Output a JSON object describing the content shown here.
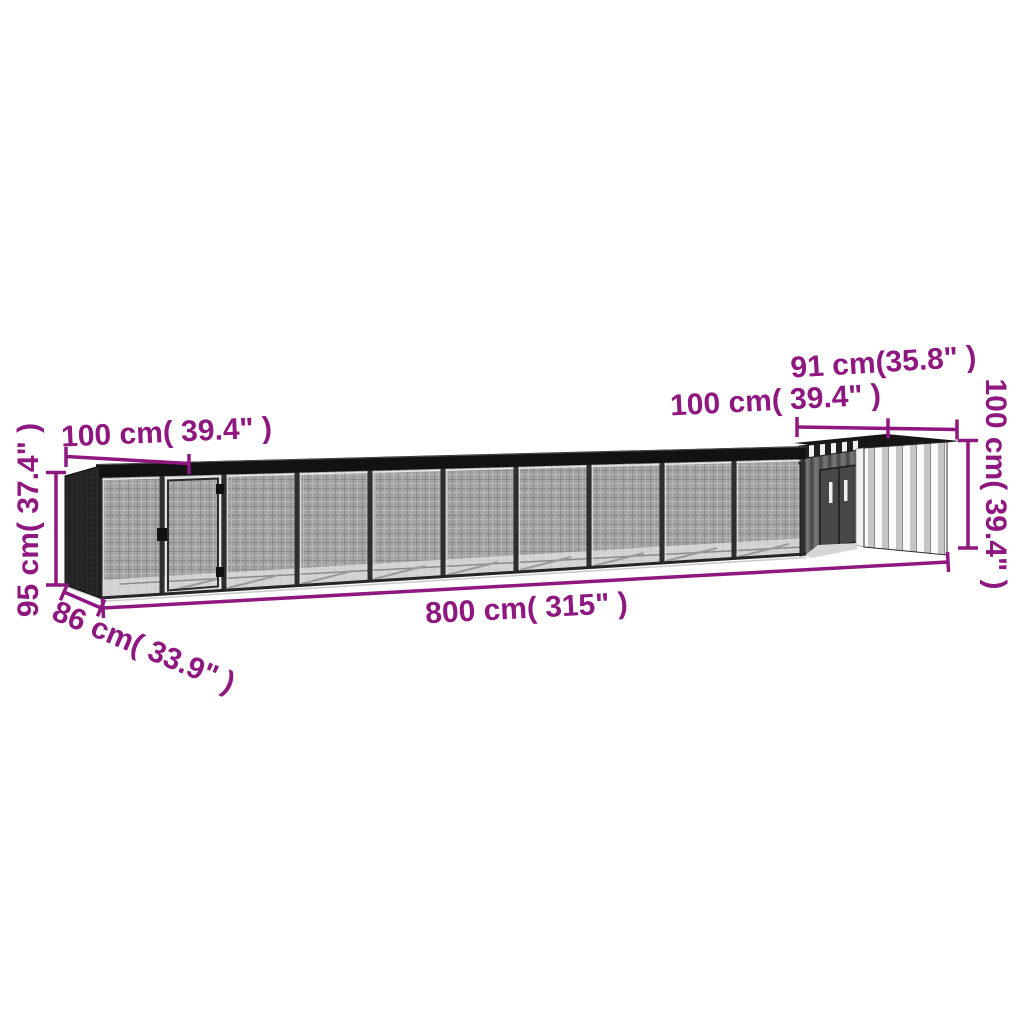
{
  "diagram_title": "Chicken cage with coop dimension diagram",
  "dimensions": {
    "run_section_width": {
      "text": "100 cm( 39.4\" )",
      "cm": 100,
      "inch": 39.4
    },
    "run_height": {
      "text": "95 cm( 37.4\" )",
      "cm": 95,
      "inch": 37.4
    },
    "run_depth": {
      "text": "86 cm( 33.9\" )",
      "cm": 86,
      "inch": 33.9
    },
    "total_length": {
      "text": "800 cm( 315\" )",
      "cm": 800,
      "inch": 315
    },
    "coop_roof_depth": {
      "text": "100 cm( 39.4\" )",
      "cm": 100,
      "inch": 39.4
    },
    "coop_width": {
      "text": "91 cm(35.8\" )",
      "cm": 91,
      "inch": 35.8
    },
    "coop_height": {
      "text": "100 cm( 39.4\" )",
      "cm": 100,
      "inch": 39.4
    }
  },
  "colors": {
    "dimension_text": "#8E1780",
    "dimension_line": "#8E1780",
    "background": "#FFFFFF",
    "frame_dark": "#1C1C1C",
    "mesh_gray": "#A0A0A0",
    "coop_panel_light": "#F4F4F4",
    "coop_panel_dark": "#5E5E5E"
  }
}
